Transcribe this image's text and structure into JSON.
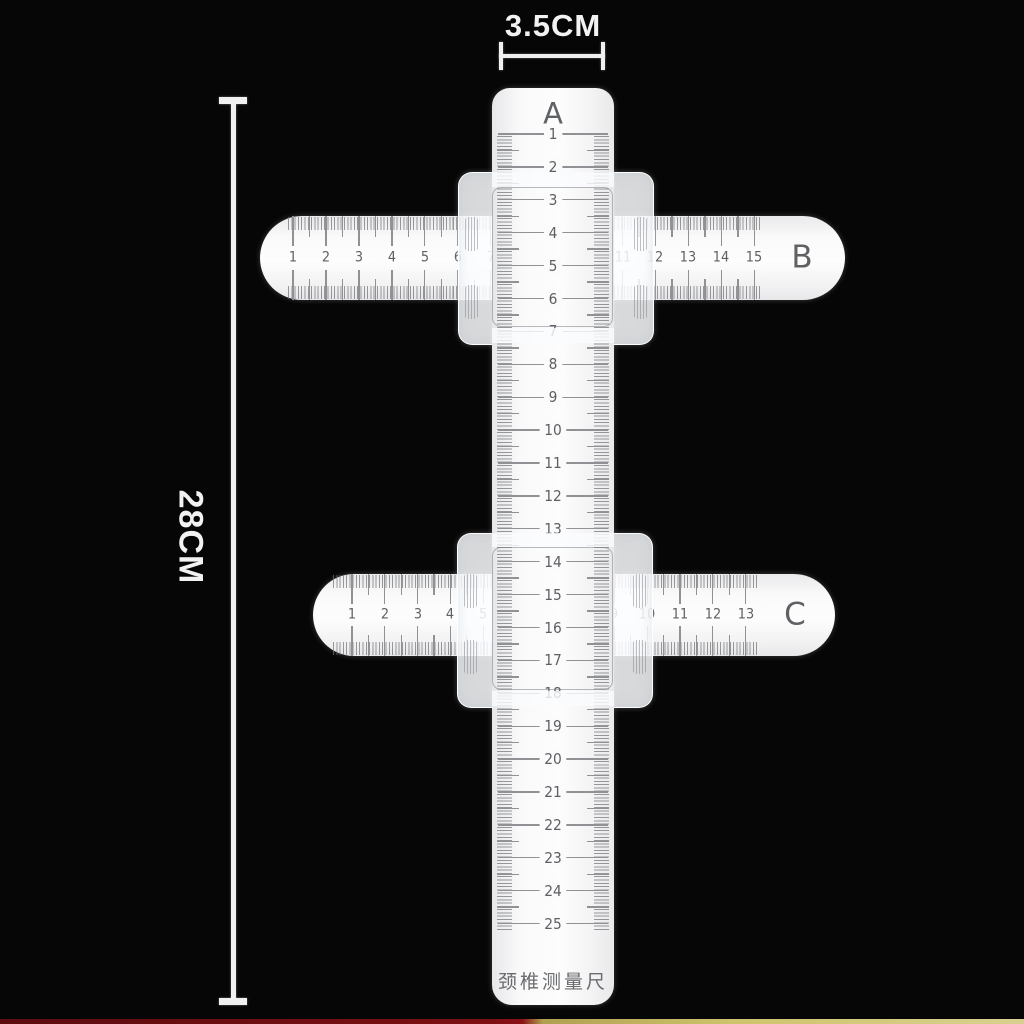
{
  "scene": {
    "description": "cervical measuring ruler set on black background"
  },
  "colors": {
    "background": "#060606",
    "annotation": "#f2f2f2",
    "ruler_surface": "#fafafa",
    "markings": "#8f9194",
    "numbers": "#5d5f62",
    "bottom_strip_left": "#7d1013",
    "bottom_strip_right": "#cfc46d"
  },
  "annotations": {
    "width": {
      "label": "3.5CM"
    },
    "height": {
      "label": "28CM"
    }
  },
  "rulers": {
    "a": {
      "label": "A",
      "start": 1,
      "end": 25,
      "footer": "颈椎测量尺"
    },
    "b": {
      "label": "B",
      "start": 1,
      "end": 15
    },
    "c": {
      "label": "C",
      "start": 1,
      "end": 13
    }
  },
  "sliders": [
    {
      "name": "upper slider block"
    },
    {
      "name": "lower slider block"
    }
  ]
}
